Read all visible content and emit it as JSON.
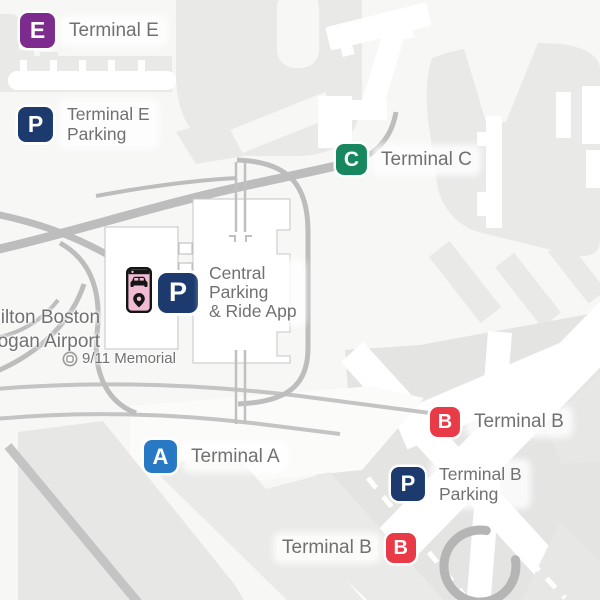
{
  "markers": {
    "terminal_e": {
      "letter": "E",
      "label": "Terminal E",
      "color": "#7d2b8c"
    },
    "terminal_e_parking": {
      "letter": "P",
      "lines": [
        "Terminal E",
        "Parking"
      ],
      "color": "#1c3a6e"
    },
    "terminal_c": {
      "letter": "C",
      "label": "Terminal C",
      "color": "#17875f"
    },
    "central_parking": {
      "letter": "P",
      "lines": [
        "Central",
        "Parking",
        "& Ride App"
      ],
      "color": "#1c3a6e"
    },
    "terminal_a": {
      "letter": "A",
      "label": "Terminal A",
      "color": "#2779c4"
    },
    "terminal_b_upper": {
      "letter": "B",
      "label": "Terminal B",
      "color": "#e93b47"
    },
    "terminal_b_parking": {
      "letter": "P",
      "lines": [
        "Terminal B",
        "Parking"
      ],
      "color": "#1c3a6e"
    },
    "terminal_b_lower": {
      "letter": "B",
      "label": "Terminal B",
      "color": "#e93b47"
    }
  },
  "poi": {
    "hotel": {
      "lines": [
        "Hilton Boston",
        "Logan Airport"
      ]
    },
    "memorial": {
      "label": "9/11 Memorial"
    }
  },
  "colors": {
    "terminal_e": "#7d2b8c",
    "parking": "#1c3a6e",
    "terminal_c": "#17875f",
    "terminal_a": "#2779c4",
    "terminal_b": "#e93b47",
    "label_text": "#717171",
    "land": "#e9e9e8",
    "road": "#bdbdbd",
    "background": "#f7f7f6",
    "phone_screen": "#f0bcd4"
  }
}
